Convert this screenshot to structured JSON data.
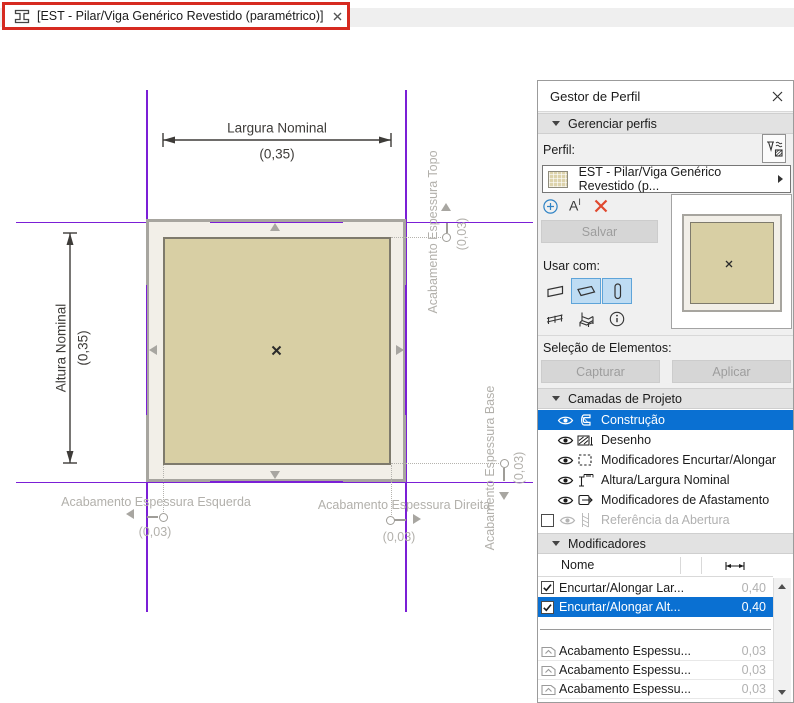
{
  "tab": {
    "title": "[EST - Pilar/Viga Genérico Revestido (paramétrico)]"
  },
  "canvas": {
    "width_dim": {
      "label": "Largura Nominal",
      "value": "(0,35)"
    },
    "height_dim": {
      "label": "Altura Nominal",
      "value": "(0,35)"
    },
    "finish_top": {
      "label": "Acabamento Espessura Topo",
      "value": "(0,03)"
    },
    "finish_base": {
      "label": "Acabamento Espessura Base",
      "value": "(0,03)"
    },
    "finish_left": {
      "label": "Acabamento Espessura Esquerda",
      "value": "(0,03)"
    },
    "finish_right": {
      "label": "Acabamento Espessura Direita",
      "value": "(0,03)"
    }
  },
  "panel": {
    "title": "Gestor de Perfil",
    "manage_section": "Gerenciar perfis",
    "profile_label": "Perfil:",
    "profile_value": "EST - Pilar/Viga Genérico Revestido (p...",
    "tools": {
      "rename_a": "A",
      "rename_i": "I"
    },
    "save_button": "Salvar",
    "use_with_label": "Usar com:",
    "selection_label": "Seleção de Elementos:",
    "capture_button": "Capturar",
    "apply_button": "Aplicar",
    "layers_section": "Camadas de Projeto",
    "layers": [
      {
        "label": "Construção",
        "selected": true
      },
      {
        "label": "Desenho"
      },
      {
        "label": "Modificadores Encurtar/Alongar"
      },
      {
        "label": "Altura/Largura Nominal"
      },
      {
        "label": "Modificadores de Afastamento"
      },
      {
        "label": "Referência da Abertura",
        "disabled": true
      }
    ],
    "modifiers_section": "Modificadores",
    "table": {
      "name_col": "Nome",
      "rows": [
        {
          "name": "Encurtar/Alongar Lar...",
          "value": "0,40",
          "checked": true
        },
        {
          "name": "Encurtar/Alongar Alt...",
          "value": "0,40",
          "checked": true,
          "selected": true
        },
        {
          "name": "Acabamento Espessu...",
          "value": "0,03"
        },
        {
          "name": "Acabamento Espessu...",
          "value": "0,03"
        },
        {
          "name": "Acabamento Espessu...",
          "value": "0,03"
        }
      ]
    }
  },
  "colors": {
    "selection_blue": "#0a70d2",
    "guide_purple": "#7b1fd6",
    "annotation_red": "#d62a20",
    "core_fill": "#d8cfa4",
    "finish_fill": "#f2efe8",
    "delete_red": "#e0482e",
    "add_blue": "#2f83c5"
  },
  "icons": {
    "tab_icon": "i-beam-section",
    "picker_icon": "profile-picker",
    "use_with": [
      "wall",
      "beam",
      "column",
      "railing",
      "object-chair",
      "info"
    ]
  }
}
